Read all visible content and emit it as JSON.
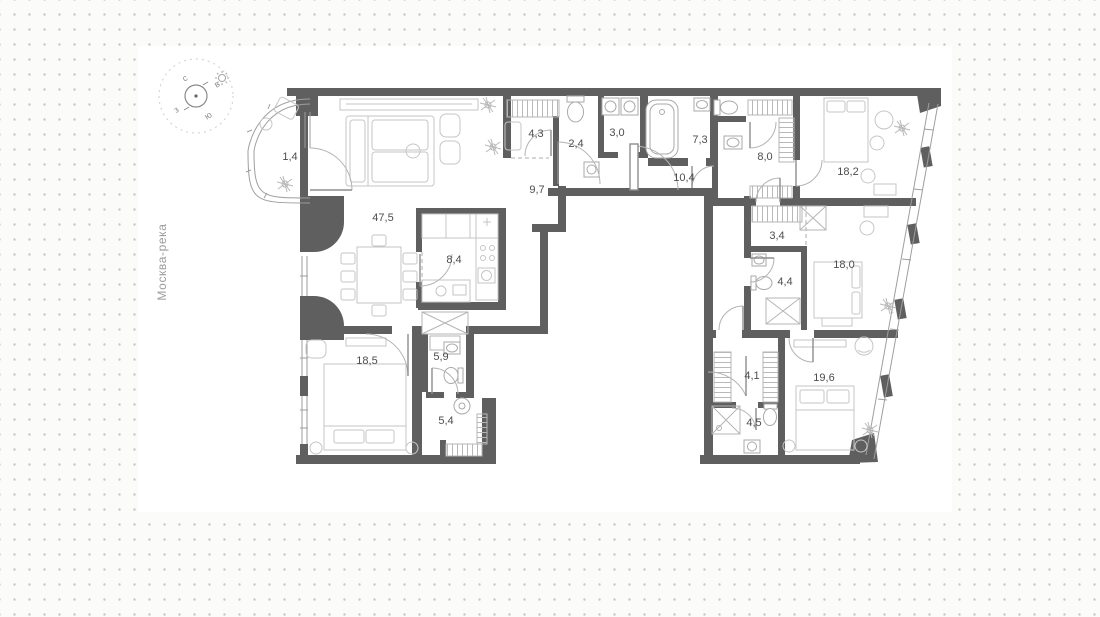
{
  "page": {
    "type": "apartment-floor-plan"
  },
  "river_label": "Москва-река",
  "compass": {
    "north": "с",
    "east": "в",
    "south": "ю",
    "west": "з",
    "sun": "sun-icon"
  },
  "colors": {
    "background": "#fbfbfa",
    "dots": "#c9c9c9",
    "plan_background": "#ffffff",
    "walls": "#5f5f5f",
    "furniture_lines": "#c6c6c6",
    "fixture_lines": "#a9a9a9",
    "label_text": "#4d4d4d",
    "river_text": "#9c9c9c"
  },
  "rooms": [
    {
      "id": "balcony",
      "label": "1,4"
    },
    {
      "id": "living-dining",
      "label": "47,5"
    },
    {
      "id": "wardrobe-1",
      "label": "4,3"
    },
    {
      "id": "wc",
      "label": "2,4"
    },
    {
      "id": "laundry",
      "label": "3,0"
    },
    {
      "id": "bathroom-1",
      "label": "7,3"
    },
    {
      "id": "hallway-1",
      "label": "9,7"
    },
    {
      "id": "entrance-hall",
      "label": "10,4"
    },
    {
      "id": "bathroom-2",
      "label": "8,0"
    },
    {
      "id": "bedroom-1",
      "label": "18,2"
    },
    {
      "id": "wardrobe-2",
      "label": "3,4"
    },
    {
      "id": "bedroom-2",
      "label": "18,0"
    },
    {
      "id": "bathroom-3",
      "label": "4,4"
    },
    {
      "id": "kitchen",
      "label": "8,4"
    },
    {
      "id": "bedroom-3",
      "label": "18,5"
    },
    {
      "id": "bathroom-4",
      "label": "5,9"
    },
    {
      "id": "hallway-2",
      "label": "5,4"
    },
    {
      "id": "wardrobe-3",
      "label": "4,1"
    },
    {
      "id": "bedroom-4",
      "label": "19,6"
    },
    {
      "id": "bathroom-5",
      "label": "4,5"
    }
  ]
}
